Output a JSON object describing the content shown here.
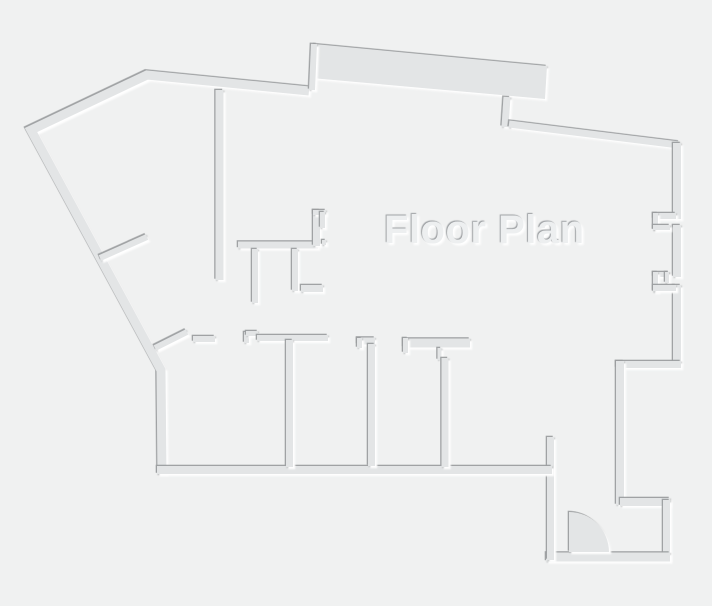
{
  "page": {
    "width": 712,
    "height": 606,
    "background": "#f0f1f1"
  },
  "plan": {
    "title": "Floor Plan",
    "colors": {
      "background": "#f0f1f1",
      "wall": "#e3e5e6",
      "shadow_dark": "#9b9ea0",
      "highlight": "#ffffff",
      "text": "#edeff0"
    },
    "band": {
      "id": "top-thick-wall-slab",
      "pts": [
        [
          314,
          44
        ],
        [
          547,
          66
        ],
        [
          545,
          99
        ],
        [
          311,
          78
        ]
      ]
    },
    "door": {
      "id": "entry-door-swing",
      "cx": 569,
      "cy": 552,
      "r": 40
    },
    "walls": [
      {
        "id": "west-northwest-outer-wall",
        "w": 9,
        "pts": [
          [
            162,
            474
          ],
          [
            161,
            370
          ],
          [
            31,
            130
          ],
          [
            147,
            75
          ],
          [
            309,
            91
          ]
        ]
      },
      {
        "id": "top-step-up-wall",
        "w": 6,
        "pts": [
          [
            312,
            90
          ],
          [
            314,
            44
          ]
        ]
      },
      {
        "id": "top-step-down-wall",
        "w": 7,
        "pts": [
          [
            507,
            97
          ],
          [
            505,
            127
          ]
        ]
      },
      {
        "id": "top-right-outer-wall",
        "w": 7,
        "pts": [
          [
            509,
            124
          ],
          [
            679,
            145
          ]
        ]
      },
      {
        "id": "east-wall-upper",
        "w": 8,
        "pts": [
          [
            677,
            143
          ],
          [
            677,
            219
          ]
        ]
      },
      {
        "id": "east-wall-between-windows",
        "w": 8,
        "pts": [
          [
            677,
            225
          ],
          [
            677,
            277
          ]
        ]
      },
      {
        "id": "east-wall-lower",
        "w": 8,
        "pts": [
          [
            677,
            285
          ],
          [
            677,
            364
          ]
        ]
      },
      {
        "id": "east-window1-top-jamb",
        "w": 6,
        "pts": [
          [
            653,
            216
          ],
          [
            676,
            216
          ]
        ]
      },
      {
        "id": "east-window1-left-jamb",
        "w": 5,
        "pts": [
          [
            655.5,
            213
          ],
          [
            655.5,
            230
          ]
        ]
      },
      {
        "id": "east-window1-bottom-jamb",
        "w": 5,
        "pts": [
          [
            653,
            227.5
          ],
          [
            670,
            227.5
          ]
        ]
      },
      {
        "id": "east-window2-top-jamb",
        "w": 5,
        "pts": [
          [
            653,
            274.5
          ],
          [
            669,
            274.5
          ]
        ]
      },
      {
        "id": "east-window2-hook",
        "w": 4,
        "pts": [
          [
            667,
            272
          ],
          [
            667,
            283
          ]
        ]
      },
      {
        "id": "east-window2-left-jamb",
        "w": 5,
        "pts": [
          [
            655.5,
            272
          ],
          [
            655.5,
            292
          ]
        ]
      },
      {
        "id": "east-window2-bottom-jamb",
        "w": 6,
        "pts": [
          [
            653,
            288
          ],
          [
            676,
            288
          ]
        ]
      },
      {
        "id": "east-wing-south-wall",
        "w": 7,
        "pts": [
          [
            616,
            364.5
          ],
          [
            681,
            364.5
          ]
        ]
      },
      {
        "id": "east-wing-west-wall",
        "w": 8,
        "pts": [
          [
            620,
            361
          ],
          [
            620,
            505
          ]
        ]
      },
      {
        "id": "vestibule-north-wall",
        "w": 8,
        "pts": [
          [
            620,
            502
          ],
          [
            670,
            502
          ]
        ]
      },
      {
        "id": "vestibule-east-wall",
        "w": 7,
        "pts": [
          [
            666.5,
            500
          ],
          [
            666.5,
            560
          ]
        ]
      },
      {
        "id": "vestibule-south-wall",
        "w": 9,
        "pts": [
          [
            546,
            557
          ],
          [
            670,
            557
          ]
        ]
      },
      {
        "id": "vestibule-west-wall",
        "w": 7,
        "pts": [
          [
            550.5,
            437
          ],
          [
            550.5,
            560
          ]
        ]
      },
      {
        "id": "south-outer-wall",
        "w": 8,
        "pts": [
          [
            157,
            470
          ],
          [
            552,
            470
          ]
        ]
      },
      {
        "id": "upper-room-divider-wall",
        "w": 8,
        "pts": [
          [
            219.5,
            90
          ],
          [
            219.5,
            280
          ]
        ]
      },
      {
        "id": "center-horizontal-wall",
        "w": 7,
        "pts": [
          [
            238,
            245
          ],
          [
            318,
            245
          ]
        ]
      },
      {
        "id": "center-vertical-riser-wall",
        "w": 7,
        "pts": [
          [
            316.5,
            210
          ],
          [
            316.5,
            246
          ]
        ]
      },
      {
        "id": "center-top-cap-wall",
        "w": 5,
        "pts": [
          [
            313,
            212.5
          ],
          [
            326,
            212.5
          ]
        ]
      },
      {
        "id": "center-cap-leg-wall",
        "w": 5,
        "pts": [
          [
            322.5,
            212
          ],
          [
            322.5,
            228
          ]
        ]
      },
      {
        "id": "center-corner-nub",
        "w": 4,
        "pts": [
          [
            324,
            240
          ],
          [
            324,
            245
          ]
        ]
      },
      {
        "id": "center-stub-a-wall",
        "w": 6,
        "pts": [
          [
            255,
            249
          ],
          [
            255,
            303
          ]
        ]
      },
      {
        "id": "center-stub-b-wall",
        "w": 6,
        "pts": [
          [
            295,
            249
          ],
          [
            295,
            291
          ]
        ]
      },
      {
        "id": "center-foot-wall",
        "w": 7,
        "pts": [
          [
            301,
            288.5
          ],
          [
            323,
            288.5
          ]
        ]
      },
      {
        "id": "west-diagonal-stub-upper",
        "w": 6,
        "pts": [
          [
            100,
            258
          ],
          [
            147,
            237
          ]
        ]
      },
      {
        "id": "west-diagonal-stub-lower",
        "w": 6,
        "pts": [
          [
            155,
            348
          ],
          [
            187,
            332
          ]
        ]
      },
      {
        "id": "corridor-wall-piece-1",
        "w": 6,
        "pts": [
          [
            193,
            339
          ],
          [
            215,
            339
          ]
        ]
      },
      {
        "id": "corridor-jamb-step-vertical",
        "w": 5,
        "pts": [
          [
            246.5,
            332
          ],
          [
            246.5,
            343
          ]
        ]
      },
      {
        "id": "corridor-jamb-step-horizontal",
        "w": 5,
        "pts": [
          [
            246,
            333.5
          ],
          [
            258,
            333.5
          ]
        ]
      },
      {
        "id": "corridor-wall-piece-2",
        "w": 6,
        "pts": [
          [
            257,
            338
          ],
          [
            328,
            338
          ]
        ]
      },
      {
        "id": "corridor-wall-piece-3",
        "w": 7,
        "pts": [
          [
            357,
            341
          ],
          [
            375,
            341
          ]
        ]
      },
      {
        "id": "corridor-piece-3-hook",
        "w": 5,
        "pts": [
          [
            359.5,
            338
          ],
          [
            359.5,
            348
          ]
        ]
      },
      {
        "id": "room-divider-wall-2",
        "w": 7,
        "pts": [
          [
            371.5,
            344
          ],
          [
            371.5,
            466
          ]
        ]
      },
      {
        "id": "corridor-wall-piece-4",
        "w": 9,
        "pts": [
          [
            403,
            343
          ],
          [
            470,
            343
          ]
        ]
      },
      {
        "id": "corridor-piece-4-hook",
        "w": 5,
        "pts": [
          [
            405.5,
            338
          ],
          [
            405.5,
            353
          ]
        ]
      },
      {
        "id": "door-jamb-tick",
        "w": 4,
        "pts": [
          [
            439.5,
            348
          ],
          [
            439.5,
            360
          ]
        ]
      },
      {
        "id": "room-divider-wall-3",
        "w": 7,
        "pts": [
          [
            445,
            358
          ],
          [
            445,
            467
          ]
        ]
      },
      {
        "id": "room-divider-wall-1",
        "w": 7,
        "pts": [
          [
            289.5,
            340
          ],
          [
            289.5,
            467
          ]
        ]
      }
    ]
  }
}
